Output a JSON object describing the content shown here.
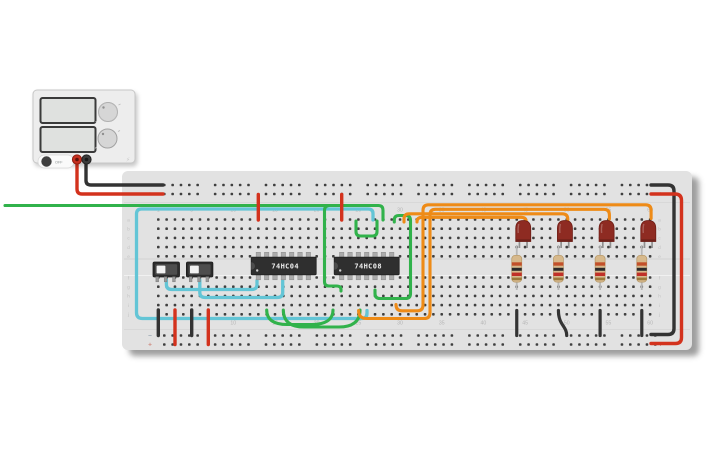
{
  "app": {
    "canvas_background": "#ffffff"
  },
  "power_supply": {
    "button_label": "OFF",
    "icons": {
      "power_bolt": "⚡",
      "power_button": "power-knob"
    },
    "display_top_value": "",
    "display_bottom_value": "",
    "terminal_positive_color": "#c62f1f",
    "terminal_negative_color": "#3c3c3c"
  },
  "breadboard": {
    "column_labels": [
      "1",
      "5",
      "10",
      "15",
      "20",
      "25",
      "30",
      "35",
      "40",
      "45",
      "50",
      "55",
      "60"
    ],
    "columns_total": 60,
    "rail_groups": 10,
    "row_letters_top": [
      "a",
      "b",
      "c",
      "d",
      "e"
    ],
    "row_letters_bottom": [
      "f",
      "g",
      "h",
      "i",
      "j"
    ],
    "rail_negative_label": "−",
    "rail_positive_label": "+",
    "rail_negative_color": "#9aa6b2",
    "rail_positive_color": "#cf8b80",
    "board_color": "#e2e2e2",
    "hole_color": "#3f3f3f"
  },
  "components": {
    "ics": [
      {
        "label": "74HC04"
      },
      {
        "label": "74HC08"
      }
    ],
    "switches": [
      {
        "state": "left"
      },
      {
        "state": "left"
      }
    ],
    "leds": [
      {
        "color": "#8e2b22"
      },
      {
        "color": "#8e2b22"
      },
      {
        "color": "#8e2b22"
      },
      {
        "color": "#8e2b22"
      }
    ],
    "resistors": [
      {
        "body": "#d7b98c",
        "bands": [
          "#c2502a",
          "#2b2b2b",
          "#c03028",
          "#9c7a3c"
        ]
      },
      {
        "body": "#d7b98c",
        "bands": [
          "#c2502a",
          "#2b2b2b",
          "#c03028",
          "#9c7a3c"
        ]
      },
      {
        "body": "#d7b98c",
        "bands": [
          "#c2502a",
          "#2b2b2b",
          "#c03028",
          "#9c7a3c"
        ]
      },
      {
        "body": "#d7b98c",
        "bands": [
          "#c2502a",
          "#2b2b2b",
          "#c03028",
          "#9c7a3c"
        ]
      }
    ]
  },
  "wires": {
    "colors": {
      "positive": "#d3321d",
      "negative": "#333333",
      "cyan": "#63c5d6",
      "green": "#31b24b",
      "orange": "#ee8b17"
    }
  }
}
